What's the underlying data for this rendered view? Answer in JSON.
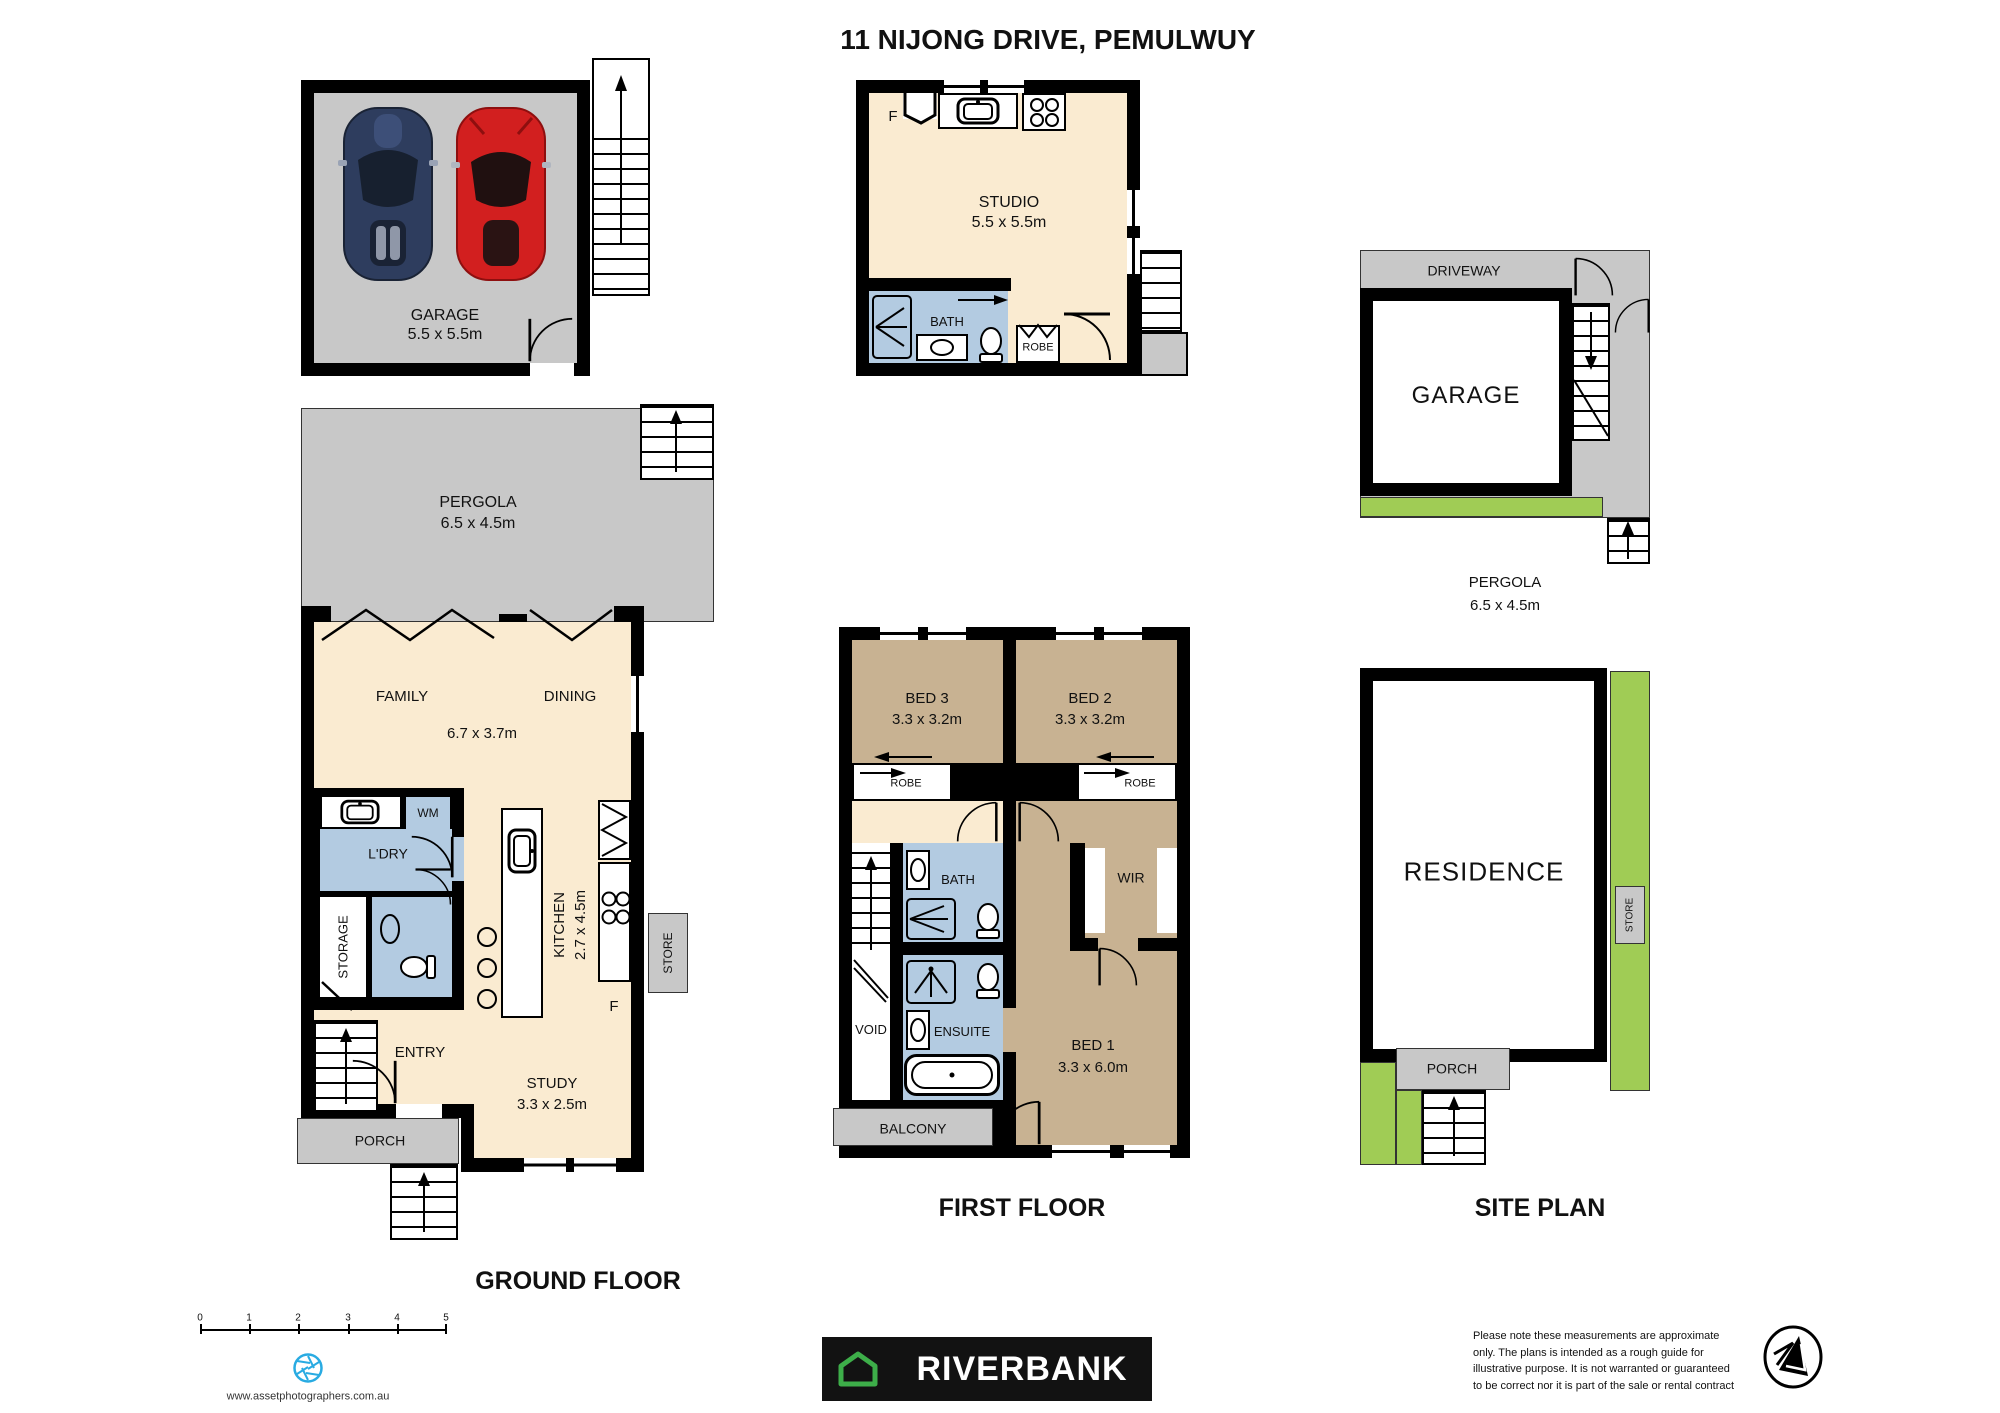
{
  "title": "11 NIJONG DRIVE, PEMULWUY",
  "garage_plan": {
    "room": "GARAGE",
    "dims": "5.5 x 5.5m"
  },
  "studio_plan": {
    "room": "STUDIO",
    "dims": "5.5 x 5.5m",
    "fridge": "F",
    "bath": "BATH",
    "robe": "ROBE"
  },
  "ground_floor": {
    "title": "GROUND FLOOR",
    "pergola": "PERGOLA",
    "pergola_dims": "6.5 x 4.5m",
    "family": "FAMILY",
    "dining": "DINING",
    "family_dining_dims": "6.7 x 3.7m",
    "wm": "WM",
    "laundry": "L'DRY",
    "storage": "STORAGE",
    "kitchen": "KITCHEN",
    "kitchen_dims": "2.7 x 4.5m",
    "store": "STORE",
    "fridge": "F",
    "entry": "ENTRY",
    "study": "STUDY",
    "study_dims": "3.3 x 2.5m",
    "porch": "PORCH"
  },
  "first_floor": {
    "title": "FIRST FLOOR",
    "bed3": "BED 3",
    "bed3_dims": "3.3 x 3.2m",
    "bed2": "BED 2",
    "bed2_dims": "3.3 x 3.2m",
    "robe": "ROBE",
    "bath": "BATH",
    "wir": "WIR",
    "void": "VOID",
    "ensuite": "ENSUITE",
    "bed1": "BED 1",
    "bed1_dims": "3.3 x 6.0m",
    "balcony": "BALCONY"
  },
  "site_plan": {
    "title": "SITE PLAN",
    "driveway": "DRIVEWAY",
    "garage": "GARAGE",
    "pergola": "PERGOLA",
    "pergola_dims": "6.5 x 4.5m",
    "residence": "RESIDENCE",
    "store": "STORE",
    "porch": "PORCH"
  },
  "footer": {
    "scale_ticks": [
      "0",
      "1",
      "2",
      "3",
      "4",
      "5"
    ],
    "photographer_url": "www.assetphotographers.com.au",
    "brand": "RIVERBANK",
    "disclaimer": "Please note these measurements are approximate only. The plans is intended as a rough guide for illustrative purpose. It is not warranted or guaranteed to be correct nor it is part of the sale or rental contract"
  },
  "colors": {
    "wall": "#000000",
    "interior_cream": "#FAEBD1",
    "bedroom_tan": "#C8B292",
    "wet_area_blue": "#B3CBE1",
    "outdoor_grey": "#C8C8C8",
    "grass_green": "#A0CC55",
    "brand_green": "#3DAE49",
    "photographer_cyan": "#29ABE2"
  }
}
